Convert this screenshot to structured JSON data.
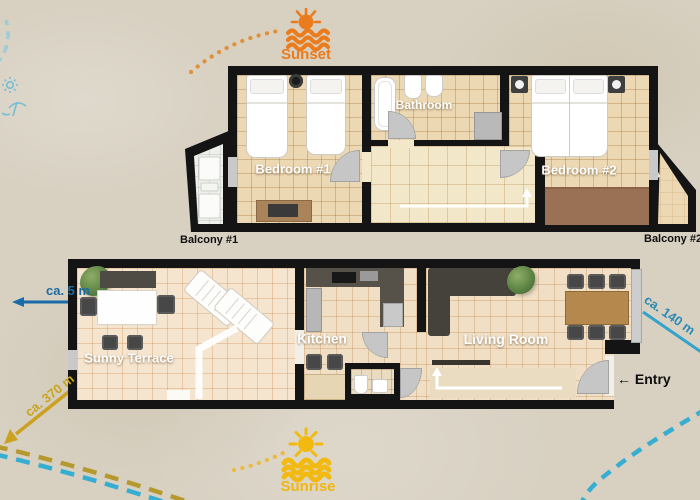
{
  "markers": {
    "sunset": "Sunset",
    "sunrise": "Sunrise"
  },
  "distances": {
    "beach": "ca. 5 m",
    "town": "ca. 370 m",
    "right": "ca. 140 m"
  },
  "upper_floor": {
    "bedroom1": "Bedroom #1",
    "bathroom": "Bathroom",
    "bedroom2": "Bedroom #2",
    "balcony1": "Balcony #1",
    "balcony2": "Balcony #2"
  },
  "lower_floor": {
    "terrace": "Sunny Terrace",
    "kitchen": "Kitchen",
    "living_room": "Living Room",
    "entry_arrow": "←",
    "entry": "Entry"
  },
  "colors": {
    "sunset_orange": "#e87c1c",
    "sunrise_yellow": "#f0b60e",
    "distance_blue": "#2277aa",
    "distance_yellow": "#c9a41d",
    "sea_dash_cyan": "#36aed2",
    "shore_dash_olive": "#b5992e",
    "wall_black": "#141414"
  }
}
